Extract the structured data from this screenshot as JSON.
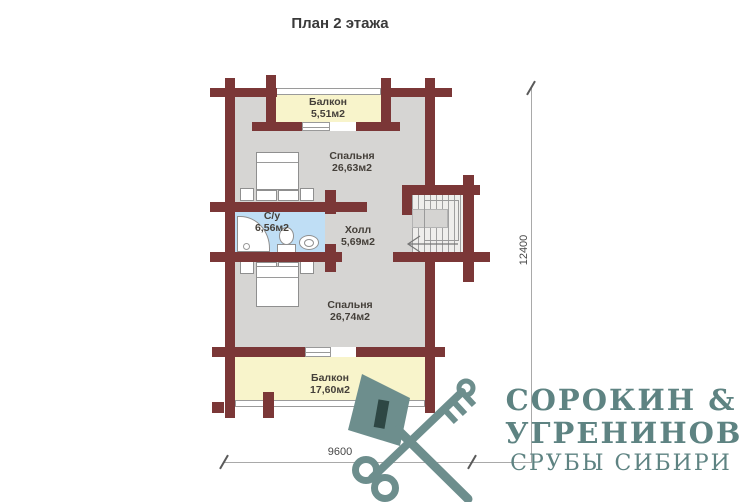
{
  "title": "План 2 этажа",
  "rooms": {
    "balcony_top": {
      "name": "Балкон",
      "area": "5,51м2"
    },
    "bedroom_top": {
      "name": "Спальня",
      "area": "26,63м2"
    },
    "bathroom": {
      "name": "С/у",
      "area": "6,56м2"
    },
    "hall": {
      "name": "Холл",
      "area": "5,69м2"
    },
    "bedroom_bottom": {
      "name": "Спальня",
      "area": "26,74м2"
    },
    "balcony_bottom": {
      "name": "Балкон",
      "area": "17,60м2"
    }
  },
  "dimensions": {
    "vertical": "12400",
    "horizontal": "9600"
  },
  "logo": {
    "name_line1": "СОРОКИН &",
    "name_line2": "УГРЕНИНОВ",
    "tagline": "СРУБЫ СИБИРИ"
  },
  "colors": {
    "wall": "#7b3737",
    "room": "#d6d5d3",
    "balcony": "#f8f4cb",
    "bathroom": "#bfdef5",
    "logo": "#6d8e8d",
    "logo_text": "#5e8382"
  }
}
